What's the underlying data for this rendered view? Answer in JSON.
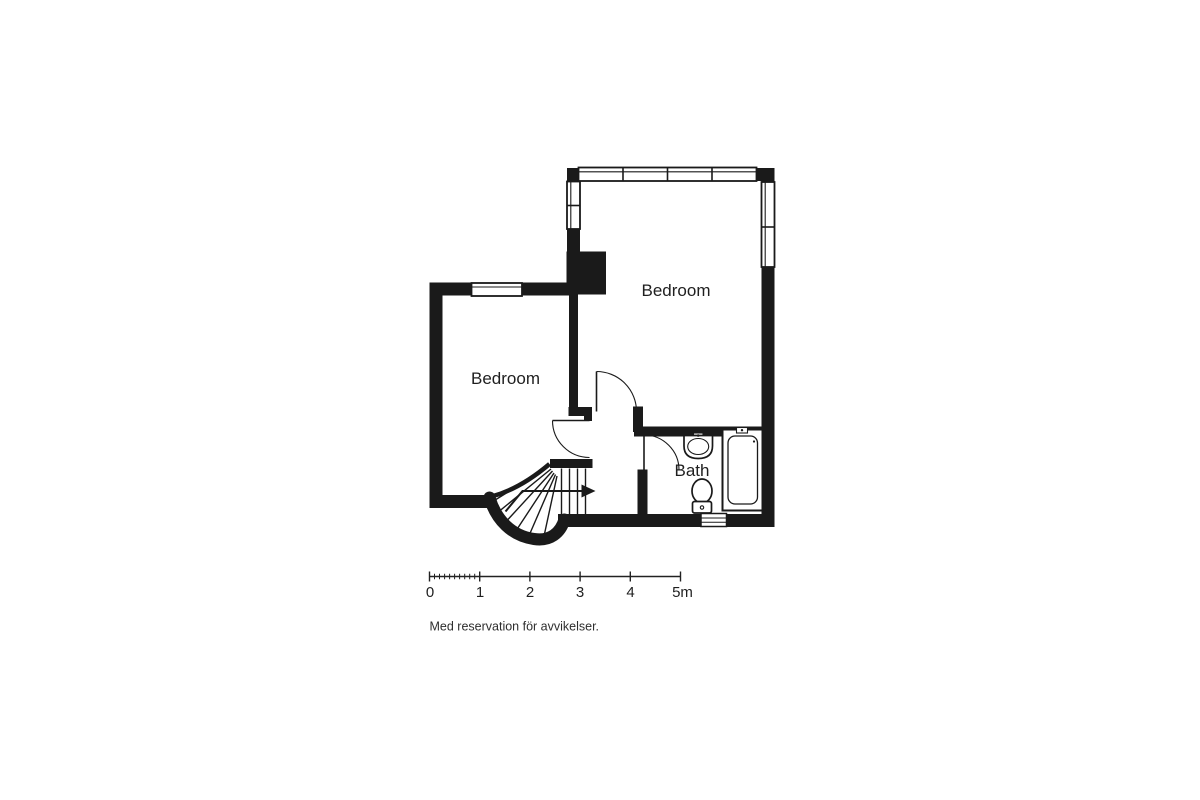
{
  "colors": {
    "wall": "#1a1a1a",
    "background": "#ffffff",
    "text": "#1f1f1f"
  },
  "rooms": [
    {
      "name": "bedroom-top",
      "label": "Bedroom"
    },
    {
      "name": "bedroom-left",
      "label": "Bedroom"
    },
    {
      "name": "bath",
      "label": "Bath"
    }
  ],
  "fixtures": [
    "staircase",
    "stair-direction-arrow",
    "sink",
    "toilet",
    "bathtub",
    "towel-radiator",
    "shaft",
    "window",
    "door-swing"
  ],
  "scale_bar": {
    "tick_labels": [
      "0",
      "1",
      "2",
      "3",
      "4",
      "5m"
    ],
    "unit": "m"
  },
  "disclaimer": "Med reservation för avvikelser."
}
